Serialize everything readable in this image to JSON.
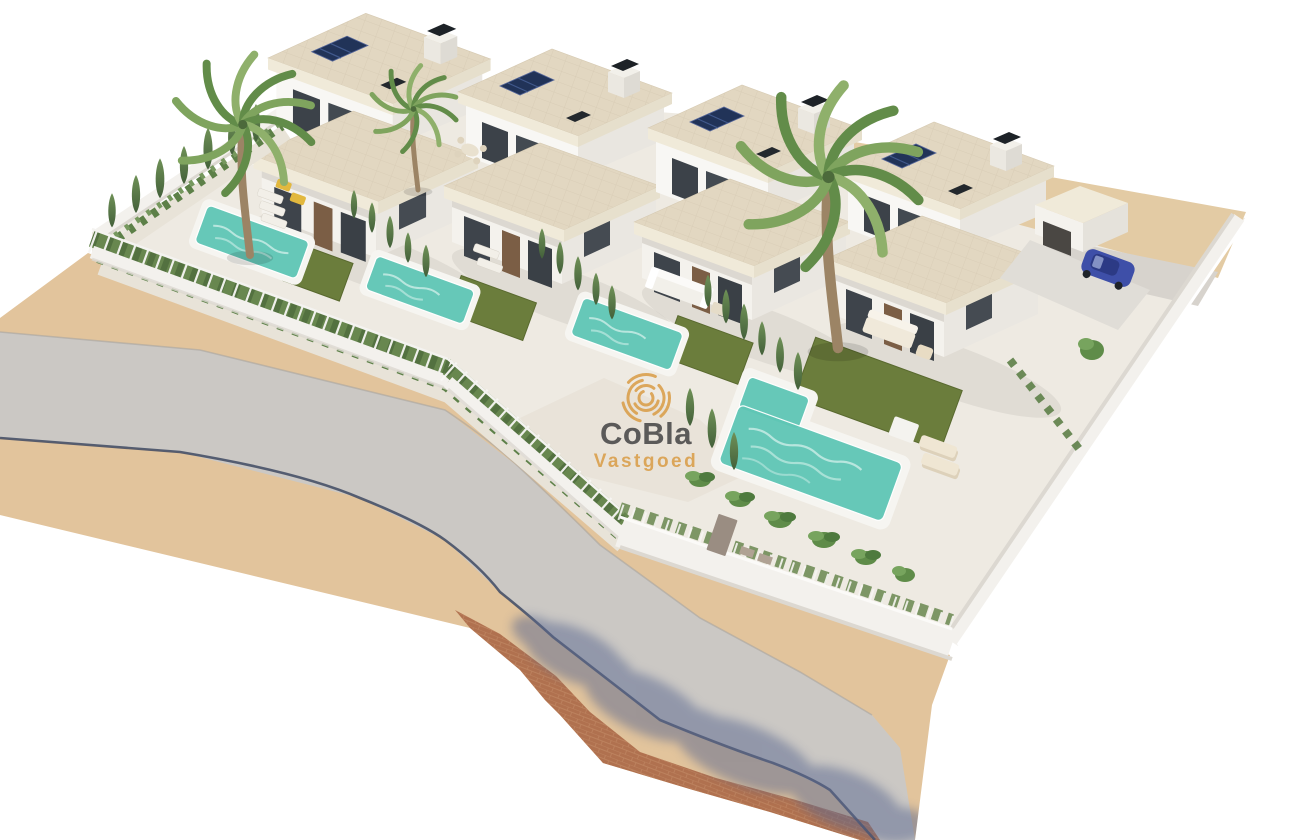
{
  "meta": {
    "type": "3d-architectural-render",
    "subject": "Aerial render of a residential development: four modern white villas with private pools, lawns, palm trees and cypress hedges along a curved asphalt road"
  },
  "watermark": {
    "brand": "CoBla",
    "subtitle": "Vastgoed",
    "logo": "spiral-rings-logo"
  },
  "scene": {
    "villas_count": 4,
    "pools_count": 4,
    "palm_trees_count": 3,
    "features": [
      "flat travertine roofs",
      "rooftop solar panels",
      "black chimney caps",
      "turquoise private pools",
      "artificial lawns",
      "sun loungers",
      "white perimeter wall and mesh fence",
      "cypress and hedge planting",
      "curved asphalt road with tan sidewalks",
      "terracotta brick paving with tree shadows",
      "blue car on driveway",
      "outdoor sofas and dining sets"
    ]
  },
  "colors": {
    "background": "#ffffff",
    "plot": "#eeeae2",
    "road": "#cbc8c4",
    "sidewalk": "#e2c49c",
    "sand": "#e3cba4",
    "brick": "#b0714f",
    "curb": "#3f4a63",
    "wall_white": "#f3f1ed",
    "wall_shade": "#dcd8d1",
    "roof_tile": "#e2d7c1",
    "fascia": "#f0ead9",
    "water": "#5fc6b5",
    "water_light": "#cdeee7",
    "lawn": "#6b7d3c",
    "hedge": "#68874f",
    "gravel": "#e8e3d8",
    "glass": "#3c4249",
    "door_brown": "#7b5e45",
    "solar": "#213358",
    "shadow_blue": "#5a6890",
    "car_blue": "#3e4fa8",
    "watermark_orange": "#d9993f",
    "watermark_dark": "#3d3c3e"
  }
}
